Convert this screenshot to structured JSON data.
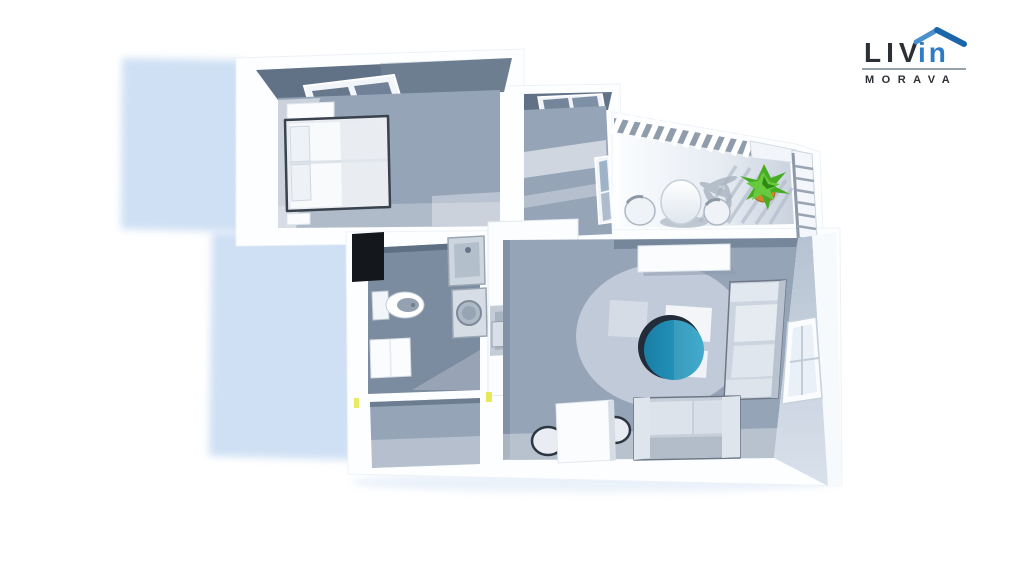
{
  "brand": {
    "word_main": "LIV",
    "word_accent": "in",
    "tagline": "MORAVA"
  },
  "colors": {
    "c-bg": "#ffffff",
    "c-shadow": "#cfe0f4",
    "c-floor": "#96a4b8",
    "c-floor-dark": "#7b8ba0",
    "c-wall-dark": "#617286",
    "c-wall-face": "#c2ccd9",
    "c-teal": "#2191b9",
    "c-teal-dark": "#187ea5",
    "c-green": "#46ad22",
    "c-green-light": "#67c93d",
    "c-pot": "#c9882f",
    "c-yellow": "#e9e75a",
    "c-niche": "#14171c",
    "c-logo-dark": "#2b3036",
    "c-logo-blue": "#2e7cc3",
    "c-logo-roof": "#1a66a8",
    "c-divider": "#97a1ab"
  },
  "scene": {
    "type": "3d-apartment-floor-plan",
    "view": "top-down-perspective-render",
    "rooms": [
      {
        "name": "bedroom",
        "furniture": [
          "double-bed",
          "pillows",
          "wardrobe",
          "nightstand",
          "skylight-window"
        ]
      },
      {
        "name": "second-room",
        "furniture": [
          "top-window",
          "side-window"
        ]
      },
      {
        "name": "balcony",
        "furniture": [
          "round-table",
          "two-chairs",
          "potted-plant",
          "slatted-railing",
          "pergola-beam"
        ]
      },
      {
        "name": "bathroom",
        "furniture": [
          "toilet",
          "steel-sink",
          "washing-machine",
          "cabinet",
          "dark-closet-niche"
        ]
      },
      {
        "name": "kitchen",
        "furniture": [
          "white-counter",
          "built-in-niche",
          "appliance-box"
        ]
      },
      {
        "name": "living-room",
        "furniture": [
          "wall-sofa",
          "lounge-sofa",
          "teal-round-coffee-table",
          "rug",
          "dining-table",
          "two-dining-chairs",
          "sideboard",
          "wall-window"
        ]
      },
      {
        "name": "hallway",
        "furniture": [
          "yellow-door-handles"
        ]
      }
    ]
  }
}
